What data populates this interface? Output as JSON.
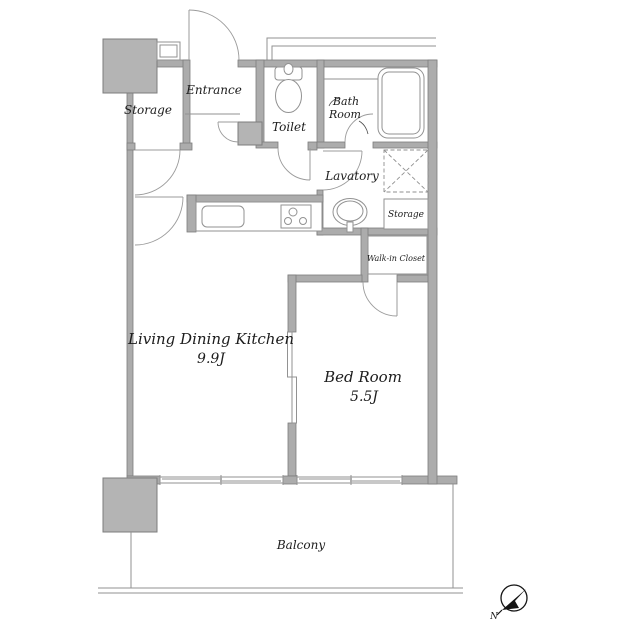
{
  "rooms": {
    "storage_top": {
      "label": "Storage"
    },
    "entrance": {
      "label": "Entrance"
    },
    "toilet": {
      "label": "Toilet"
    },
    "bath": {
      "line1": "Bath",
      "line2": "Room"
    },
    "lavatory": {
      "label": "Lavatory"
    },
    "storage_hall": {
      "label": "Storage"
    },
    "walk_in_closet": {
      "label": "Walk-in Closet"
    },
    "living_dining_kitchen": {
      "label": "Living Dining Kitchen",
      "size": "9.9J"
    },
    "bed_room": {
      "label": "Bed Room",
      "size": "5.5J"
    },
    "balcony": {
      "label": "Balcony"
    }
  },
  "compass": {
    "north": "N"
  },
  "colors": {
    "background": "#ffffff",
    "wall_fill": "#acacac",
    "wall_outline": "#7d7d7d",
    "fixture_line": "#929292",
    "text": "#1c1c1c",
    "compass": "#141414"
  }
}
